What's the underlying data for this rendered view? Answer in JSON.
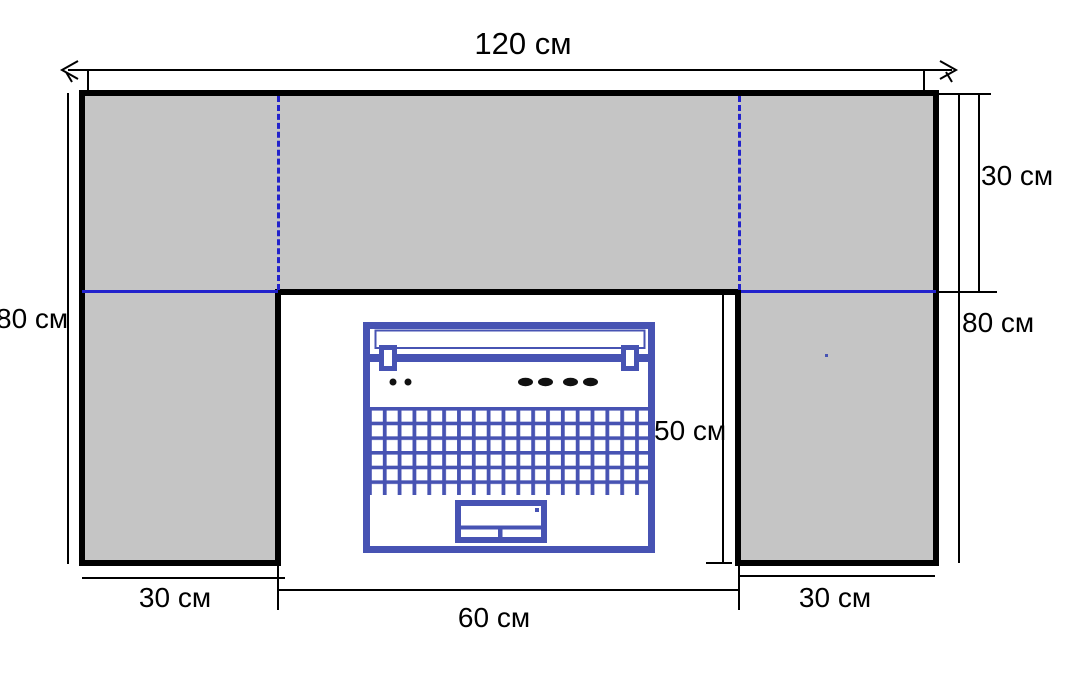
{
  "figure": {
    "type": "dimension-diagram",
    "description": "Desk / table surface plan view with laptop in cut-out",
    "units": "см",
    "labels": {
      "top_width": "120 см",
      "left_height": "80 см",
      "right_top_depth": "30 см",
      "right_height": "80 см",
      "inner_height": "50 см",
      "bottom_left_width": "30 см",
      "bottom_center_width": "60 см",
      "bottom_right_width": "30 см"
    },
    "values_cm": {
      "total_width": 120,
      "total_height": 80,
      "top_strip_depth": 30,
      "side_column_width": 30,
      "cutout_width": 60,
      "cutout_height": 50
    },
    "colors": {
      "surface_fill": "#c5c5c5",
      "outline": "#000000",
      "guide_blue": "#2222cc",
      "laptop_blue": "#4753b3",
      "background": "#ffffff"
    }
  }
}
